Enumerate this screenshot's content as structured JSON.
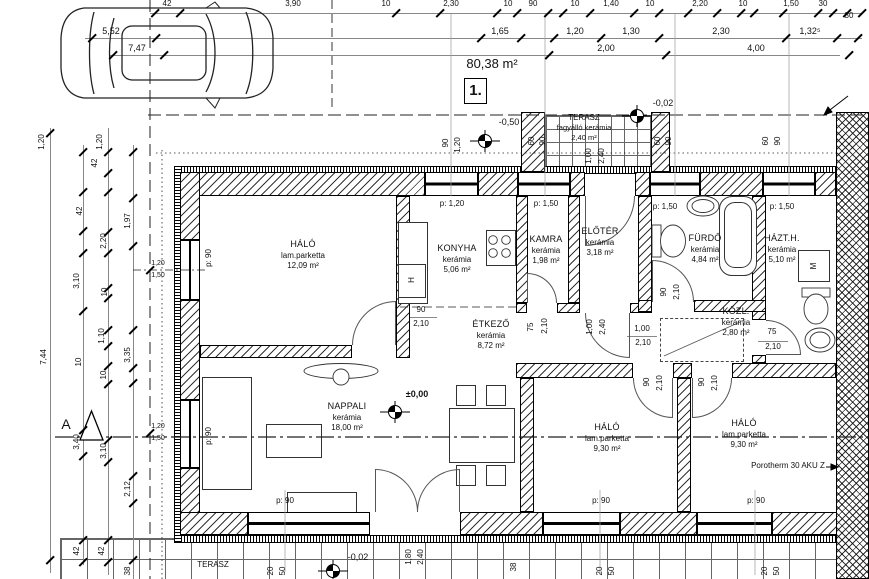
{
  "sheet": {
    "area_label": "80,38 m²",
    "plan_number": "1."
  },
  "rooms": [
    {
      "name": "HÁLÓ",
      "floor": "lam.parketta",
      "area": "12,09 m²"
    },
    {
      "name": "KONYHA",
      "floor": "kerámia",
      "area": "5,06 m²"
    },
    {
      "name": "KAMRA",
      "floor": "kerámia",
      "area": "1,98 m²"
    },
    {
      "name": "ELŐTÉR",
      "floor": "kerámia",
      "area": "3,18 m²"
    },
    {
      "name": "FÜRDŐ",
      "floor": "kerámia",
      "area": "4,84 m²"
    },
    {
      "name": "HÁZT.H.",
      "floor": "kerámia",
      "area": "5,10 m²"
    },
    {
      "name": "ÉTKEZŐ",
      "floor": "kerámia",
      "area": "8,72 m²"
    },
    {
      "name": "NAPPALI",
      "floor": "kerámia",
      "area": "18,00 m²"
    },
    {
      "name": "KÖZL.",
      "floor": "kerámia",
      "area": "2,80 m²"
    },
    {
      "name": "HÁLÓ",
      "floor": "lam.parketta",
      "area": "9,30 m²"
    },
    {
      "name": "HÁLÓ",
      "floor": "lam.parketta",
      "area": "9,30 m²"
    },
    {
      "name": "TERASZ",
      "floor": "fagyálló kerámia",
      "area": "2,40 m²"
    },
    {
      "name": "TERASZ"
    }
  ],
  "levels": {
    "main": "±0,00",
    "terrace_top": "-0,50",
    "eaves": "-0,02",
    "terrace_bottom": "-0,02"
  },
  "windows": {
    "p90": "p: 90",
    "p120": "p: 1,20",
    "p150": "p: 1,50"
  },
  "dims": {
    "top1": [
      "42",
      "3,90",
      "10",
      "2,30",
      "10",
      "90",
      "10",
      "1,40",
      "10",
      "2,20",
      "10",
      "1,50",
      "30",
      "30"
    ],
    "top2": [
      "5,52",
      "1,65",
      "1,20",
      "1,30",
      "2,30",
      "1,32⁵"
    ],
    "top3": [
      "7,47",
      "2,00",
      "4,00"
    ],
    "left": [
      "1,20",
      "1,20",
      "42",
      "42",
      "1,97",
      "2,20",
      "3,10",
      "10",
      "1,10",
      "7,44",
      "3,35",
      "10",
      "10",
      "3,40",
      "3,10",
      "2,12",
      "42",
      "42",
      "38"
    ],
    "level_pair": [
      "1,20",
      "1,50"
    ],
    "bottom": [
      "38",
      "20",
      "50",
      "20",
      "50",
      "20",
      "50",
      "1,80",
      "2,40"
    ],
    "terrace": [
      "90",
      "1,20",
      "60",
      "90",
      "1,00",
      "2,40",
      "60",
      "90",
      "60",
      "90"
    ],
    "door": {
      "w90": "90",
      "h210": "2,10",
      "w75": "75",
      "w100": "1,00",
      "h240": "2,40"
    }
  },
  "annotations": {
    "wall_type": "Porotherm 30 AKU Z",
    "section": "A",
    "fridge": "H",
    "washer": "M"
  }
}
